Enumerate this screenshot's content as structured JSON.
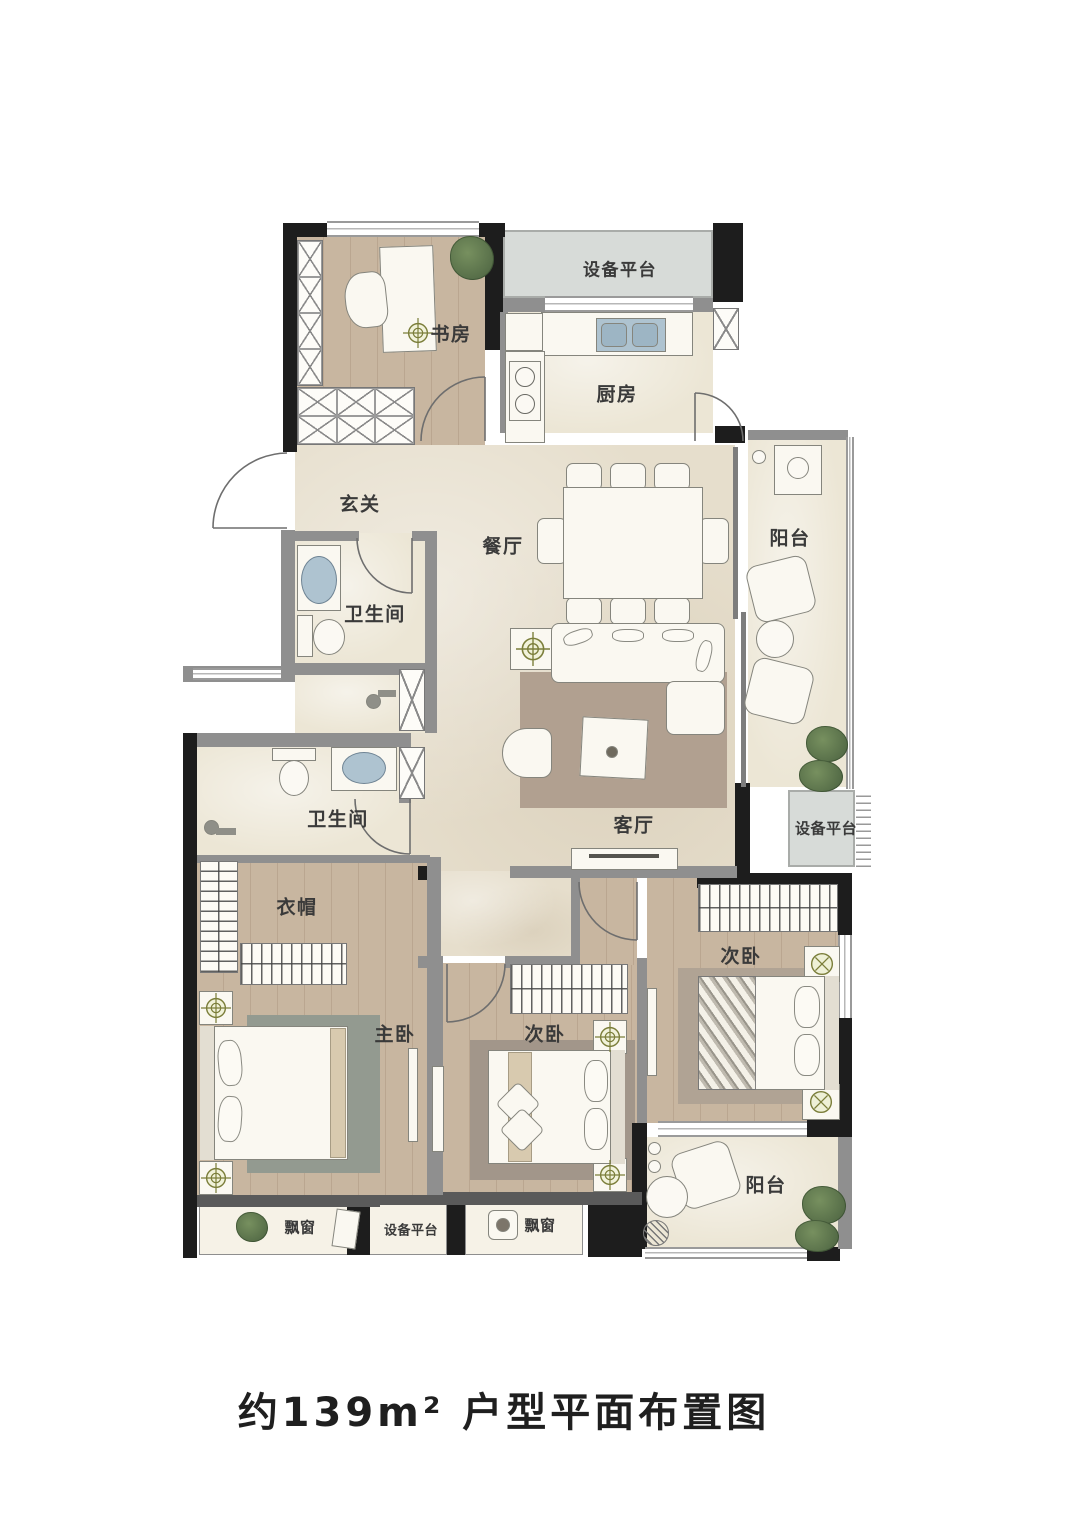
{
  "floorplan": {
    "caption": "约139m² 户型平面布置图",
    "rooms": [
      {
        "id": "equip-top",
        "label": "设备平台"
      },
      {
        "id": "study",
        "label": "书房"
      },
      {
        "id": "kitchen",
        "label": "厨房"
      },
      {
        "id": "entry",
        "label": "玄关"
      },
      {
        "id": "dining",
        "label": "餐厅"
      },
      {
        "id": "balcony-right",
        "label": "阳台"
      },
      {
        "id": "bath-upper",
        "label": "卫生间"
      },
      {
        "id": "bath-lower",
        "label": "卫生间"
      },
      {
        "id": "living",
        "label": "客厅"
      },
      {
        "id": "equip-right",
        "label": "设备平台"
      },
      {
        "id": "cloakroom",
        "label": "衣帽"
      },
      {
        "id": "bedroom-right",
        "label": "次卧"
      },
      {
        "id": "master-bedroom",
        "label": "主卧"
      },
      {
        "id": "bedroom-middle",
        "label": "次卧"
      },
      {
        "id": "balcony-bottom",
        "label": "阳台"
      },
      {
        "id": "bay-window-left",
        "label": "飘窗"
      },
      {
        "id": "equip-bottom",
        "label": "设备平台"
      },
      {
        "id": "bay-window-mid",
        "label": "飘窗"
      }
    ],
    "colors": {
      "wall": "#1d1d1d",
      "partition": "#8f8f8f",
      "floor_main": "#e6decc",
      "floor_wood": "#c8b6a0",
      "floor_wet": "#ece6d5",
      "platform": "#d7dbd8",
      "symbol_olive": "#7b7e3a",
      "plant_green": "#5c7352"
    }
  }
}
